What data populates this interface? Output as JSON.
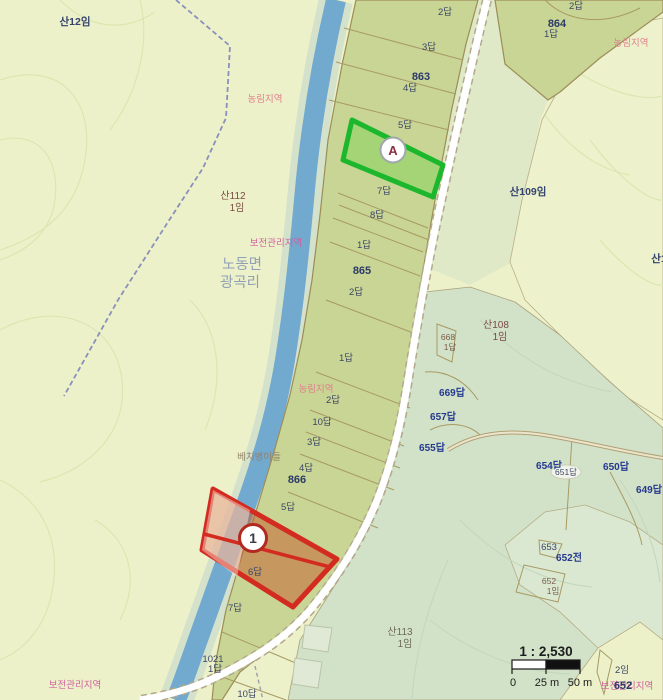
{
  "map": {
    "colors": {
      "background": "#edf1c9",
      "east_band": "#dfe9c8",
      "forest": "#d2e2c8",
      "forest_pocket": "#dbe8d1",
      "river": "#72a9cf",
      "river_bank": "#d4e2cb",
      "paddy": "#c8d594",
      "parcel_border": "#a3915a",
      "road_fill": "#ffffff",
      "road_casing": "#b3a88c",
      "admin_dash": "#8890bb",
      "highlight_green_stroke": "#1cb72c",
      "highlight_green_fill": "rgba(120,210,80,0.45)",
      "highlight_red_stroke": "#d32b20",
      "highlight_red_fill": "rgba(195,90,42,0.50)",
      "marker_a_letter": "#8a3040",
      "marker_1_border": "#b22920"
    },
    "markers": {
      "a": {
        "label": "A"
      },
      "one": {
        "label": "1"
      }
    },
    "scale": {
      "ratio": "1 : 2,530",
      "tick0": "0",
      "tick25": "25 m",
      "tick50": "50 m"
    },
    "labels": [
      {
        "text": "2답",
        "x": 445,
        "y": 15,
        "cls": "lp"
      },
      {
        "text": "3답",
        "x": 429,
        "y": 50,
        "cls": "lp"
      },
      {
        "text": "863",
        "x": 421,
        "y": 80,
        "cls": "lb"
      },
      {
        "text": "4답",
        "x": 410,
        "y": 91,
        "cls": "lp"
      },
      {
        "text": "5답",
        "x": 405,
        "y": 128,
        "cls": "lp"
      },
      {
        "text": "7답",
        "x": 384,
        "y": 194,
        "cls": "lp"
      },
      {
        "text": "8답",
        "x": 377,
        "y": 218,
        "cls": "lp"
      },
      {
        "text": "1답",
        "x": 364,
        "y": 248,
        "cls": "lp"
      },
      {
        "text": "865",
        "x": 362,
        "y": 274,
        "cls": "lb"
      },
      {
        "text": "2답",
        "x": 356,
        "y": 295,
        "cls": "lp"
      },
      {
        "text": "1답",
        "x": 346,
        "y": 361,
        "cls": "lp"
      },
      {
        "text": "농림지역",
        "x": 316,
        "y": 392,
        "cls": "lzp"
      },
      {
        "text": "2답",
        "x": 333,
        "y": 403,
        "cls": "lp"
      },
      {
        "text": "10답",
        "x": 322,
        "y": 425,
        "cls": "lp"
      },
      {
        "text": "3답",
        "x": 314,
        "y": 445,
        "cls": "lp"
      },
      {
        "text": "4답",
        "x": 306,
        "y": 471,
        "cls": "lp"
      },
      {
        "text": "866",
        "x": 297,
        "y": 483,
        "cls": "lb"
      },
      {
        "text": "5답",
        "x": 288,
        "y": 510,
        "cls": "lp"
      },
      {
        "text": "6답",
        "x": 255,
        "y": 575,
        "cls": "lp"
      },
      {
        "text": "7답",
        "x": 235,
        "y": 611,
        "cls": "lp"
      },
      {
        "text": "1021",
        "x": 213,
        "y": 662,
        "cls": "lp"
      },
      {
        "text": "1답",
        "x": 215,
        "y": 672,
        "cls": "lp"
      },
      {
        "text": "10답",
        "x": 247,
        "y": 697,
        "cls": "lp"
      },
      {
        "text": "864",
        "x": 557,
        "y": 27,
        "cls": "lb"
      },
      {
        "text": "1답",
        "x": 551,
        "y": 37,
        "cls": "lp"
      },
      {
        "text": "2답",
        "x": 576,
        "y": 9,
        "cls": "lp"
      },
      {
        "text": "농림지역",
        "x": 265,
        "y": 102,
        "cls": "lzp"
      },
      {
        "text": "농림지역",
        "x": 631,
        "y": 46,
        "cls": "lzp"
      },
      {
        "text": "보전관리지역",
        "x": 276,
        "y": 246,
        "cls": "lzm"
      },
      {
        "text": "보전관리지역",
        "x": 75,
        "y": 688,
        "cls": "lzm"
      },
      {
        "text": "보전관리지역",
        "x": 627,
        "y": 689,
        "cls": "lzm"
      },
      {
        "text": "652",
        "x": 623,
        "y": 689,
        "cls": "lb"
      },
      {
        "text": "노동면",
        "x": 242,
        "y": 269,
        "cls": "lpl"
      },
      {
        "text": "광곡리",
        "x": 240,
        "y": 287,
        "cls": "lpl"
      },
      {
        "text": "베치병이들",
        "x": 259,
        "y": 460,
        "cls": "lf"
      },
      {
        "text": "산12임",
        "x": 75,
        "y": 25,
        "cls": "lmn"
      },
      {
        "text": "산112",
        "x": 233,
        "y": 199,
        "cls": "lmb"
      },
      {
        "text": "1임",
        "x": 237,
        "y": 211,
        "cls": "lmb"
      },
      {
        "text": "산109임",
        "x": 528,
        "y": 195,
        "cls": "lmn"
      },
      {
        "text": "산108",
        "x": 496,
        "y": 328,
        "cls": "lmb"
      },
      {
        "text": "1임",
        "x": 500,
        "y": 340,
        "cls": "lmb"
      },
      {
        "text": "산113",
        "x": 400,
        "y": 635,
        "cls": "lmg"
      },
      {
        "text": "1임",
        "x": 405,
        "y": 647,
        "cls": "lmg"
      },
      {
        "text": "산1",
        "x": 659,
        "y": 262,
        "cls": "lmn"
      },
      {
        "text": "668",
        "x": 448,
        "y": 340,
        "cls": "lsb"
      },
      {
        "text": "1답",
        "x": 450,
        "y": 350,
        "cls": "lsb"
      },
      {
        "text": "669답",
        "x": 452,
        "y": 396,
        "cls": "lnb"
      },
      {
        "text": "657답",
        "x": 443,
        "y": 420,
        "cls": "lnb"
      },
      {
        "text": "655답",
        "x": 432,
        "y": 451,
        "cls": "lnb"
      },
      {
        "text": "654답",
        "x": 549,
        "y": 469,
        "cls": "lnb"
      },
      {
        "text": "651답",
        "x": 566,
        "y": 475,
        "cls": "halo"
      },
      {
        "text": "650답",
        "x": 616,
        "y": 470,
        "cls": "lnb"
      },
      {
        "text": "649답",
        "x": 649,
        "y": 493,
        "cls": "lnb"
      },
      {
        "text": "653",
        "x": 549,
        "y": 550,
        "cls": "lp"
      },
      {
        "text": "652전",
        "x": 569,
        "y": 561,
        "cls": "lnb"
      },
      {
        "text": "652",
        "x": 549,
        "y": 584,
        "cls": "lsb"
      },
      {
        "text": "1임",
        "x": 553,
        "y": 594,
        "cls": "lsb"
      },
      {
        "text": "2임",
        "x": 622,
        "y": 673,
        "cls": "lp"
      }
    ]
  }
}
